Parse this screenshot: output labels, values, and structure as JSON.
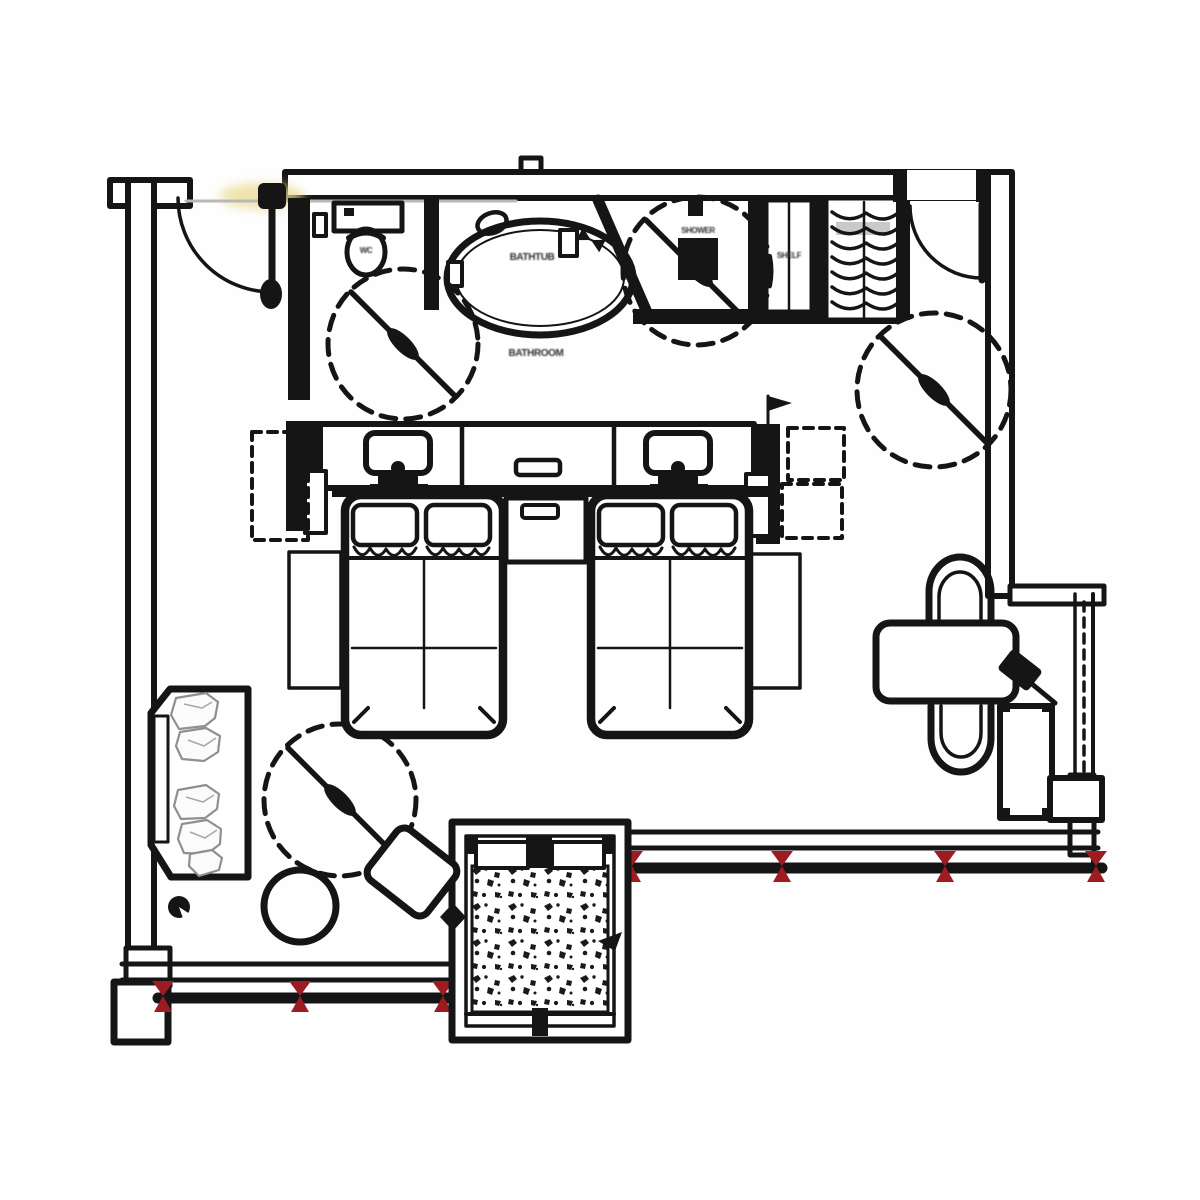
{
  "meta": {
    "type": "architectural-floor-plan",
    "subject": "hotel twin guest room",
    "view": "top-down plan"
  },
  "palette": {
    "line": "#151515",
    "background": "#fefefe",
    "mullion_red": "#9e1c21",
    "door_highlight_yellow": "#ead98f",
    "faint_line_gray": "#b8b8b8"
  },
  "labels": {
    "bathroom": "BATHROOM",
    "bathtub": "BATHTUB",
    "shower": "SHOWER",
    "wc": "WC",
    "shelf": "SHELF"
  },
  "elements": {
    "doors": [
      "connecting-door-top-left",
      "entry-door-top-right"
    ],
    "bathroom": [
      "toilet",
      "toilet-paper-holder",
      "bathtub",
      "tub-faucet",
      "mixer-handle",
      "oval-mirror",
      "shower-drain",
      "shower-head"
    ],
    "wardrobe": [
      "hanging-rail",
      "clothes-hangers",
      "shelf-unit"
    ],
    "bedroom": [
      "twin-bed-1",
      "twin-bed-2",
      "pillows",
      "nightstand",
      "headboard-console",
      "bedside-lamp-1",
      "bedside-lamp-2",
      "drawer-handle",
      "bedside-bench-1",
      "bedside-bench-2",
      "overhead-dashed-units"
    ],
    "living": [
      "sofa",
      "seat-cushions",
      "floor-lamp",
      "round-side-table",
      "square-coffee-table"
    ],
    "work": [
      "desk",
      "chair-1",
      "chair-2",
      "tv-on-swivel-arm",
      "side-cabinet"
    ],
    "windows": [
      "south-window-wall",
      "east-window-wall",
      "bay-window-terrazzo-floor"
    ],
    "markers": {
      "turning_circles": 4,
      "mullion_marks_bottom_left": 3,
      "mullion_marks_right": 4,
      "diamond_marker": 1,
      "arrow_marker": 1,
      "switch_flag": 1
    }
  }
}
